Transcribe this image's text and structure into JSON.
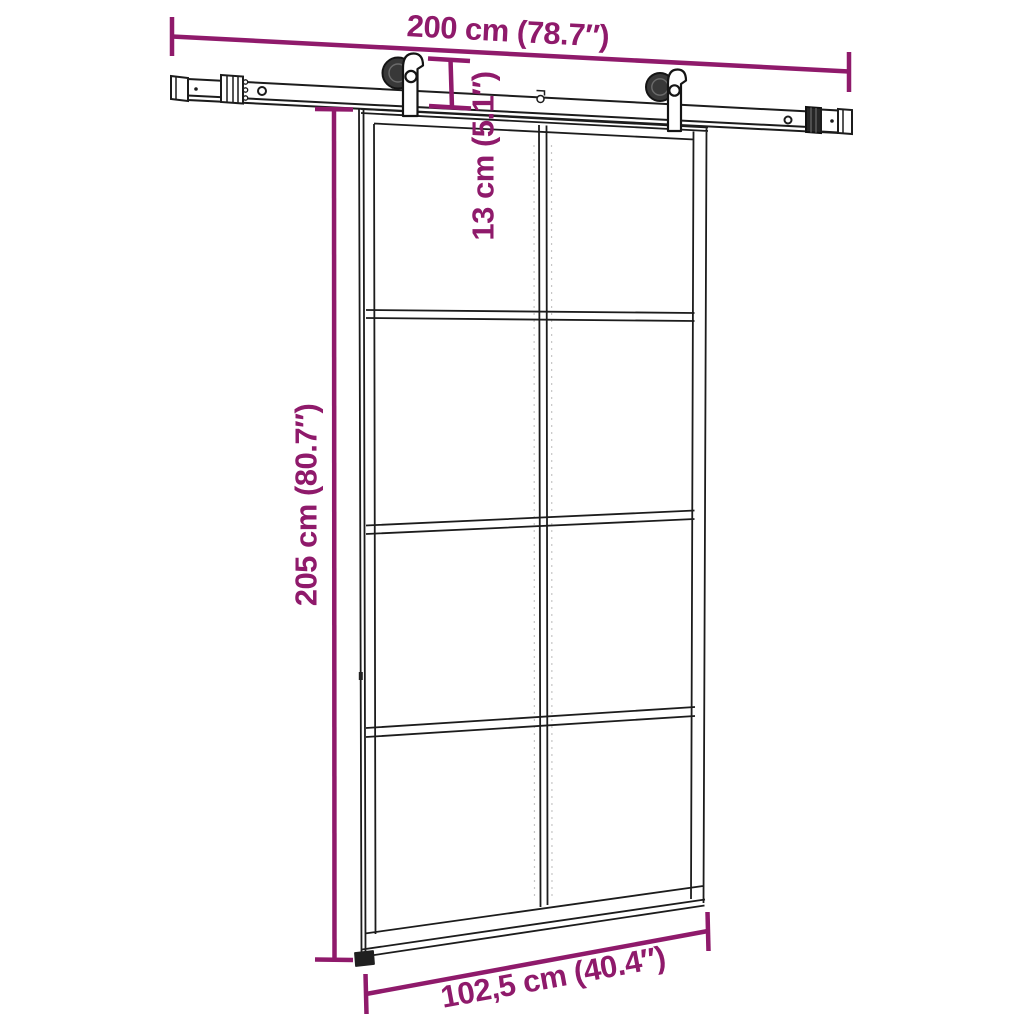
{
  "figure": {
    "background": "#ffffff",
    "line_color": "#1c1c1c",
    "hardware_fill": "#383838",
    "dimension_color": "#8F1A6B",
    "dimensions": {
      "rail_width": "200 cm (78.7″)",
      "hardware_height": "13 cm (5.1″)",
      "door_height": "205 cm (80.7″)",
      "door_width": "102,5 cm (40.4″)"
    },
    "door": {
      "glass_rows": 4,
      "glass_columns": 2,
      "rollers": 2
    }
  }
}
